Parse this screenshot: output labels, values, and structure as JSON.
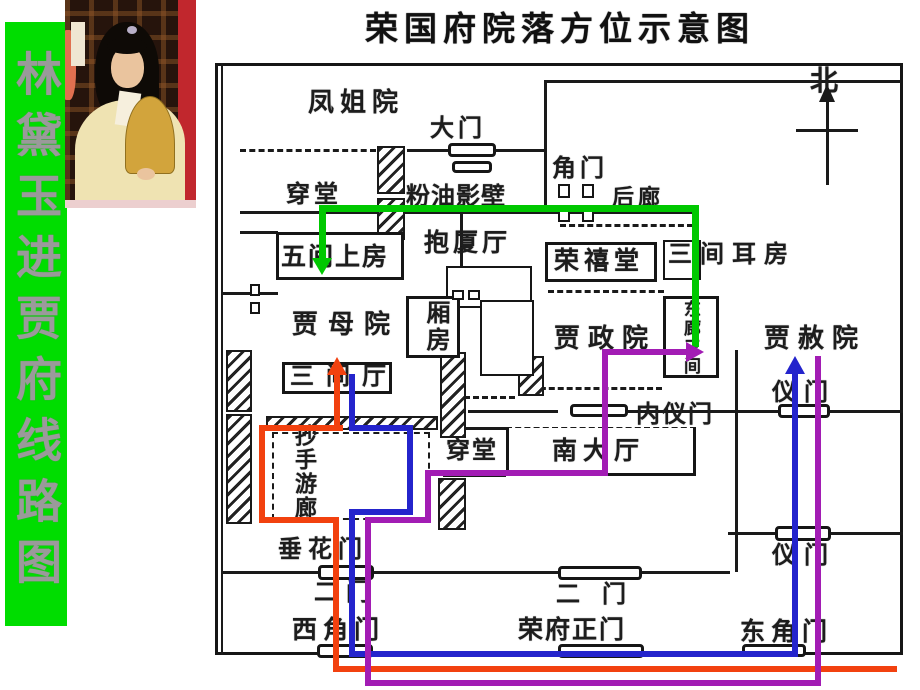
{
  "banner": {
    "text": "林黛玉进贾府线路图",
    "bg_color": "#00dd00",
    "text_color": "#9a9a9a"
  },
  "title": "荣国府院落方位示意图",
  "compass": {
    "north_label": "北"
  },
  "rooms": {
    "fengjieyuan": "凤姐院",
    "damen": "大门",
    "chuantang_n": "穿堂",
    "fenyouyingbi": "粉油影壁",
    "jiaomen": "角门",
    "houlang": "后廊",
    "wujianshangfang": "五间上房",
    "baoshating": "抱厦厅",
    "rongxitang": "荣禧堂",
    "sanjianerfang": "三间耳房",
    "jiamuyuan": "贾母院",
    "xiangfang": "厢房",
    "donglangsanjian": "东廊三间",
    "jiazhengyuan": "贾政院",
    "jiasheyuan": "贾赦院",
    "sanjianting": "三间厅",
    "neiyimen": "内仪门",
    "yimen_ne": "仪门",
    "yimen_se": "仪门",
    "chuantang_s": "穿堂",
    "nandating": "南大厅",
    "chaoshouyoulang": "抄手游廊",
    "chuihuamen": "垂花门",
    "ermen_w": "二门",
    "ermen_c": "二门",
    "xijiaomen": "西角门",
    "rongfuzhengmen": "荣府正门",
    "dongjiaomen": "东角门"
  },
  "routes": {
    "green_color": "#00c800",
    "red_color": "#f2410f",
    "blue_color": "#2424cc",
    "purple_color": "#a21cb4"
  }
}
